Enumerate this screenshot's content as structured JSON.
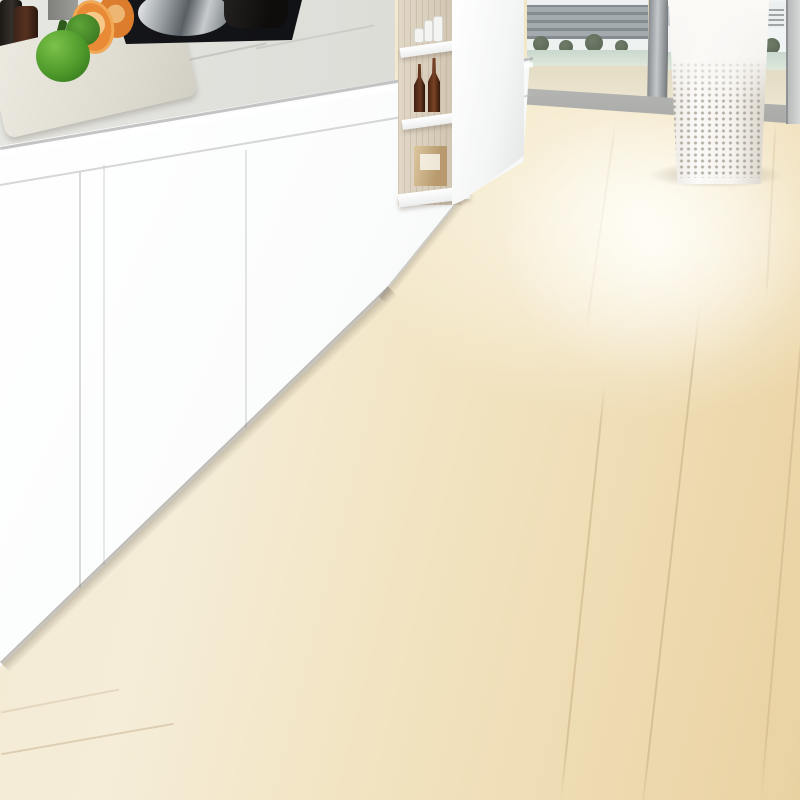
{
  "scene": {
    "type": "product-photo",
    "subject": "geometric patchwork runner rug in a modern kitchen",
    "palette": {
      "floor_wood": "#f2e4c2",
      "cabinet_white": "#f9fafa",
      "counter_marble": "#dadad5",
      "steel": "#9fa3a6",
      "oven_display_cyan": "#4cc8e8",
      "pepper_green": "#4e9a2b",
      "fruit_orange": "#e88a36",
      "bottle_brown": "#6b3a22",
      "shelf_wood": "#d8ccb8",
      "window_water": "#cfdccf",
      "window_tree": "#45513c"
    },
    "rug": {
      "quad": {
        "A": [
          483,
          196
        ],
        "B": [
          710,
          232
        ],
        "C": [
          75,
          715
        ],
        "D": [
          470,
          845
        ]
      },
      "v_curve": 0.485,
      "base_color": "#0b0b0c",
      "outline": [
        [
          497,
          198
        ],
        [
          696,
          230
        ],
        [
          703,
          250
        ],
        [
          470,
          845
        ],
        [
          95,
          722
        ],
        [
          95,
          689
        ],
        [
          469,
          214
        ]
      ],
      "shadow_offset": [
        -10,
        12
      ],
      "palette": {
        "teal": "#45809a",
        "charcoal": "#3a3a3e",
        "gray": "#8f8f92",
        "gray_dark": "#707074",
        "white": "#ebedec",
        "band_gray": "#8e8c89",
        "band_charcoal": "#434347"
      },
      "blocks": [
        {
          "name": "far-charcoal-left",
          "color": "charcoal",
          "u": [
            0.03,
            0.39
          ],
          "v": [
            0.012,
            0.105
          ]
        },
        {
          "name": "far-white",
          "color": "white",
          "u": [
            0.42,
            0.63
          ],
          "v": [
            0.012,
            0.105
          ]
        },
        {
          "name": "far-charcoal-right",
          "color": "charcoal",
          "u": [
            0.66,
            0.97
          ],
          "v": [
            0.012,
            0.105
          ]
        },
        {
          "name": "teal-left",
          "color": "teal",
          "u": [
            0.03,
            0.4
          ],
          "v": [
            0.12,
            0.3
          ]
        },
        {
          "name": "charcoal-center-tall",
          "color": "charcoal",
          "u": [
            0.43,
            0.66
          ],
          "v": [
            0.12,
            0.46
          ]
        },
        {
          "name": "teal-right",
          "color": "teal",
          "u": [
            0.69,
            0.97
          ],
          "v": [
            0.12,
            0.31
          ]
        },
        {
          "name": "white-center-right",
          "color": "white",
          "u": [
            0.66,
            0.83
          ],
          "v": [
            0.325,
            0.425
          ]
        },
        {
          "name": "charcoal-right-strip",
          "color": "charcoal",
          "u": [
            0.86,
            0.97
          ],
          "v": [
            0.325,
            0.425
          ]
        },
        {
          "name": "gray-left-dark",
          "color": "gray_dark",
          "u": [
            0.03,
            0.4
          ],
          "v": [
            0.315,
            0.445
          ]
        },
        {
          "name": "white-left-big",
          "color": "white",
          "u": [
            0.03,
            0.4
          ],
          "v": [
            0.46,
            0.875
          ]
        },
        {
          "name": "gray-center",
          "color": "gray",
          "u": [
            0.43,
            0.66
          ],
          "v": [
            0.475,
            0.6
          ]
        },
        {
          "name": "white-center-small",
          "color": "white",
          "u": [
            0.43,
            0.66
          ],
          "v": [
            0.615,
            0.7
          ]
        },
        {
          "name": "charcoal-right-big",
          "color": "charcoal",
          "u": [
            0.66,
            0.97
          ],
          "v": [
            0.44,
            0.7
          ]
        },
        {
          "name": "teal-center-square",
          "color": "teal",
          "u": [
            0.43,
            0.66
          ],
          "v": [
            0.715,
            0.875
          ]
        },
        {
          "name": "white-right-strip",
          "color": "white",
          "u": [
            0.69,
            0.79
          ],
          "v": [
            0.715,
            0.875
          ]
        },
        {
          "name": "gray-right",
          "color": "gray",
          "u": [
            0.82,
            0.97
          ],
          "v": [
            0.715,
            0.875
          ]
        },
        {
          "name": "band-gray-bottom",
          "color": "band_gray",
          "u": [
            0.03,
            0.7
          ],
          "v": [
            0.89,
            0.985
          ]
        },
        {
          "name": "band-charcoal-corner",
          "color": "band_charcoal",
          "u": [
            0.73,
            0.97
          ],
          "v": [
            0.89,
            0.985
          ]
        }
      ]
    }
  }
}
